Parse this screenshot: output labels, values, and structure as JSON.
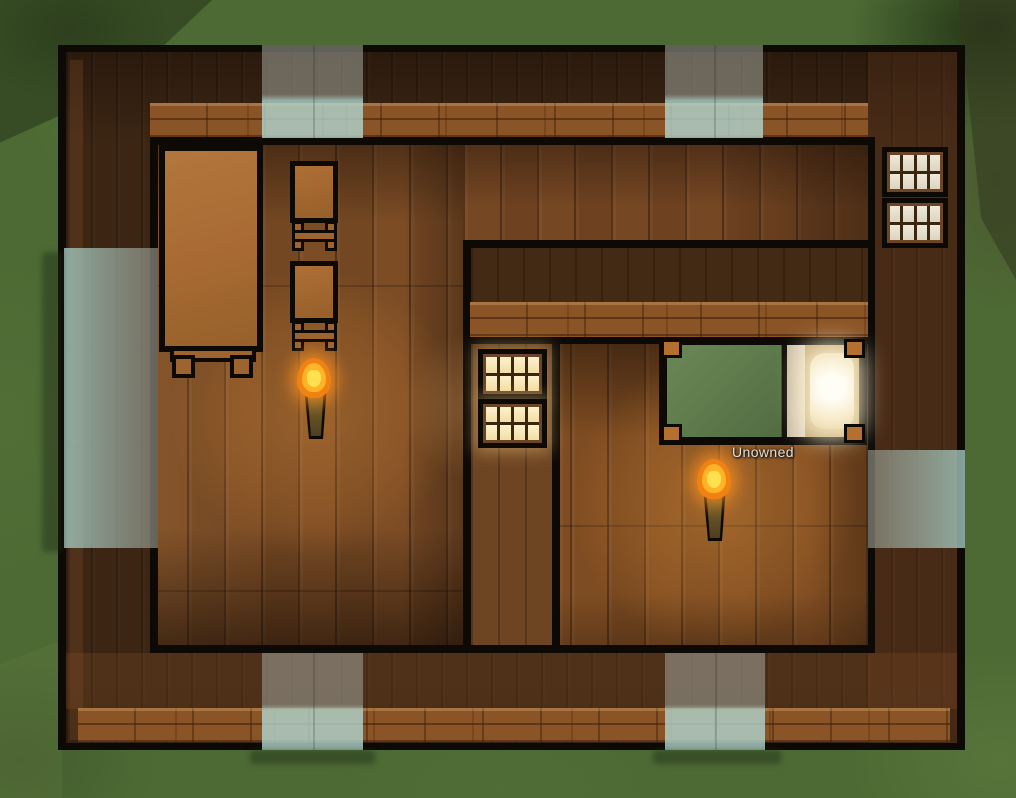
{
  "scene": {
    "description": "Top-down colony-sim view of a wooden house with two rooms, a bedroom with an unowned bed, torches, table, stools and windows",
    "labels": {
      "bed_owner": "Unowned"
    },
    "objects": [
      {
        "id": "table",
        "label": "wooden table"
      },
      {
        "id": "stool-1",
        "label": "wooden stool"
      },
      {
        "id": "stool-2",
        "label": "wooden stool"
      },
      {
        "id": "torch-left-room",
        "label": "torch lamp (lit)"
      },
      {
        "id": "torch-bedroom",
        "label": "torch lamp (lit)"
      },
      {
        "id": "bed",
        "label": "bed",
        "status": "Unowned"
      },
      {
        "id": "windows-right-wall",
        "label": "wall windows (2, daylight panes)"
      },
      {
        "id": "windows-bedroom-wall",
        "label": "wall windows (2, warm lit panes)"
      },
      {
        "id": "skylight-strips",
        "label": "translucent window/skylight strips on walls",
        "count": 6
      }
    ],
    "palette": {
      "grass": "#4d6a34",
      "wall_dark": "#3c2513",
      "wall_brick_face": "#8a5426",
      "outline_black": "#0d0a06",
      "floor_wood": "#7c4c25",
      "interior_wall_wood": "#6e4523",
      "window_pane_cool": "#e8e2d4",
      "window_pane_warm": "#f9edc2",
      "skylight_tint": "#a9cdc4",
      "blanket_green": "#5e7b4c",
      "sheet_cream": "#dcd2bd",
      "pillow_white": "#fffef6",
      "torch_flame_orange": "#f28114",
      "torch_flame_yellow": "#ffe14f",
      "furniture_wood": "#a86a32"
    }
  }
}
